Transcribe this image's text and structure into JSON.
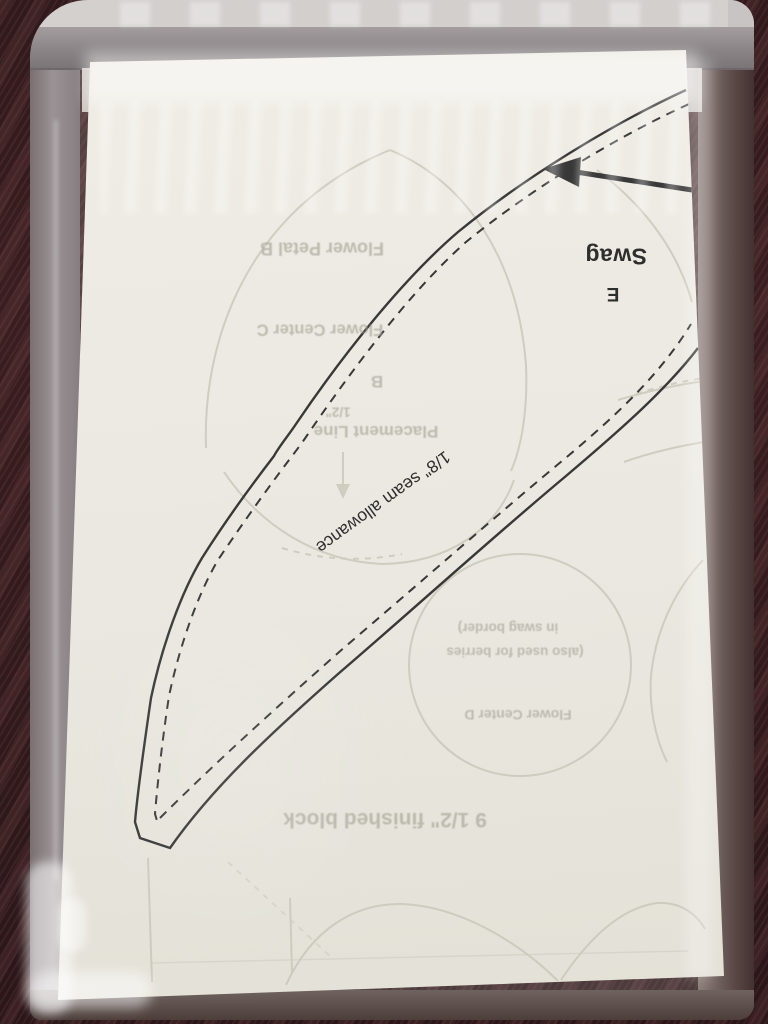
{
  "pattern": {
    "piece_name": "Swag",
    "piece_letter": "E",
    "seam_allowance_note": "1/8\" seam allowance"
  },
  "showthrough": {
    "flower_petal": "Flower Petal B",
    "flower_center_c": "Flower Center C",
    "letter_b": "B",
    "half_inch": "1/2\"",
    "placement_line": "Placement Line",
    "flower_center_d": "Flower Center D",
    "berries_note_line1": "(also used for berries",
    "berries_note_line2": "in swag border)",
    "finished_block": "9 1/2\" finished block"
  },
  "colors": {
    "wood": "#3a1d20",
    "paper": "#eae8e0",
    "print_line": "#383838",
    "showthrough_ink": "#a39f92",
    "bag_seal": "#8b8587"
  }
}
